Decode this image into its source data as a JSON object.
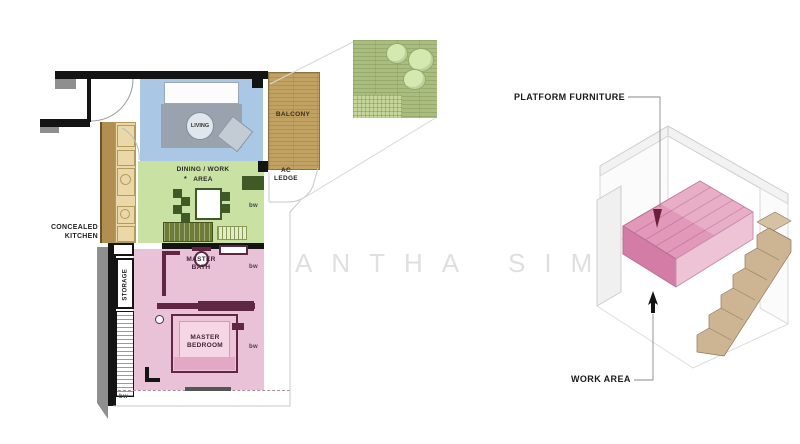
{
  "colors": {
    "wall": "#141414",
    "living": "#aac8e6",
    "dining": "#c9e2a4",
    "bedroom": "#eac2d7",
    "balcony": "#c2a263",
    "turf": "#a9bd7e",
    "platform": "#e298b9",
    "platform_dark": "#d27ca6",
    "stairs": "#cdb492",
    "accent_dark": "#5f2744"
  },
  "watermark": {
    "left": "ANTHA",
    "right": "SIM"
  },
  "plan": {
    "labels": {
      "concealed_kitchen": "CONCEALED\nKITCHEN",
      "storage": "STORAGE",
      "living": "LIVING",
      "dining_line1": "DINING / WORK",
      "dining_line2": "AREA",
      "dining_star": "*",
      "balcony": "BALCONY",
      "ac_ledge": "AC\nLEDGE",
      "master_bath": "MASTER\nBATH",
      "master_bedroom": "MASTER\nBEDROOM",
      "bw": "bw"
    }
  },
  "iso": {
    "labels": {
      "platform_furniture": "PLATFORM FURNITURE",
      "work_area": "WORK AREA"
    }
  }
}
